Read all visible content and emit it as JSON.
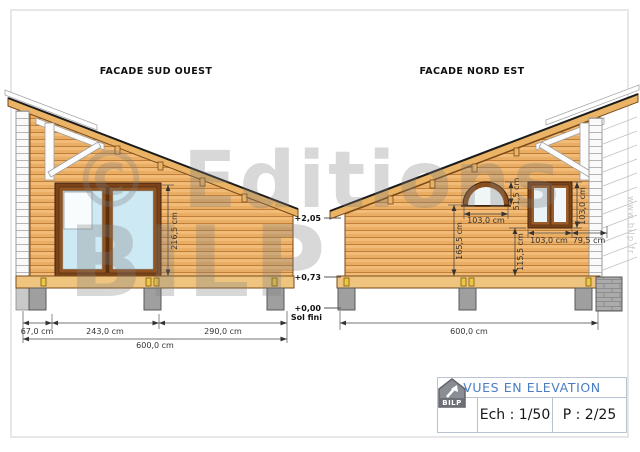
{
  "watermark": {
    "line1": "© Editions",
    "line2": "BILP",
    "website": "www.bilp.fr"
  },
  "facade_left": {
    "title": "FACADE SUD OUEST",
    "dims": {
      "bay_height": "216,5 cm",
      "left_offset": "67,0 cm",
      "bay_width": "243,0 cm",
      "right_section": "290,0 cm",
      "total_width": "600,0 cm"
    }
  },
  "facade_right": {
    "title": "FACADE NORD EST",
    "dims": {
      "arch_window_width": "103,0 cm",
      "arch_window_height": "51,5 cm",
      "arch_sill_height": "165,5 cm",
      "window_width": "103,0 cm",
      "window_height": "103,0 cm",
      "window_corner_offset": "79,5 cm",
      "window_sill_height": "115,5 cm",
      "total_width": "600,0 cm"
    }
  },
  "levels": {
    "eaves": "+2,05",
    "floor": "+0,73",
    "ground": "+0,00",
    "ground_label": "Sol fini"
  },
  "title_block": {
    "title": "VUES EN ELEVATION",
    "scale": "Ech : 1/50",
    "page": "P : 2/25",
    "logo_text": "BILP"
  },
  "colors": {
    "wood": "#e9ad64",
    "wood_outline": "#7a4a18",
    "roof": "#eab365",
    "glass": "#cde9f4",
    "concrete": "#9f9f9f",
    "accent_blue": "#4a7dc4",
    "clip_yellow": "#edc741"
  }
}
